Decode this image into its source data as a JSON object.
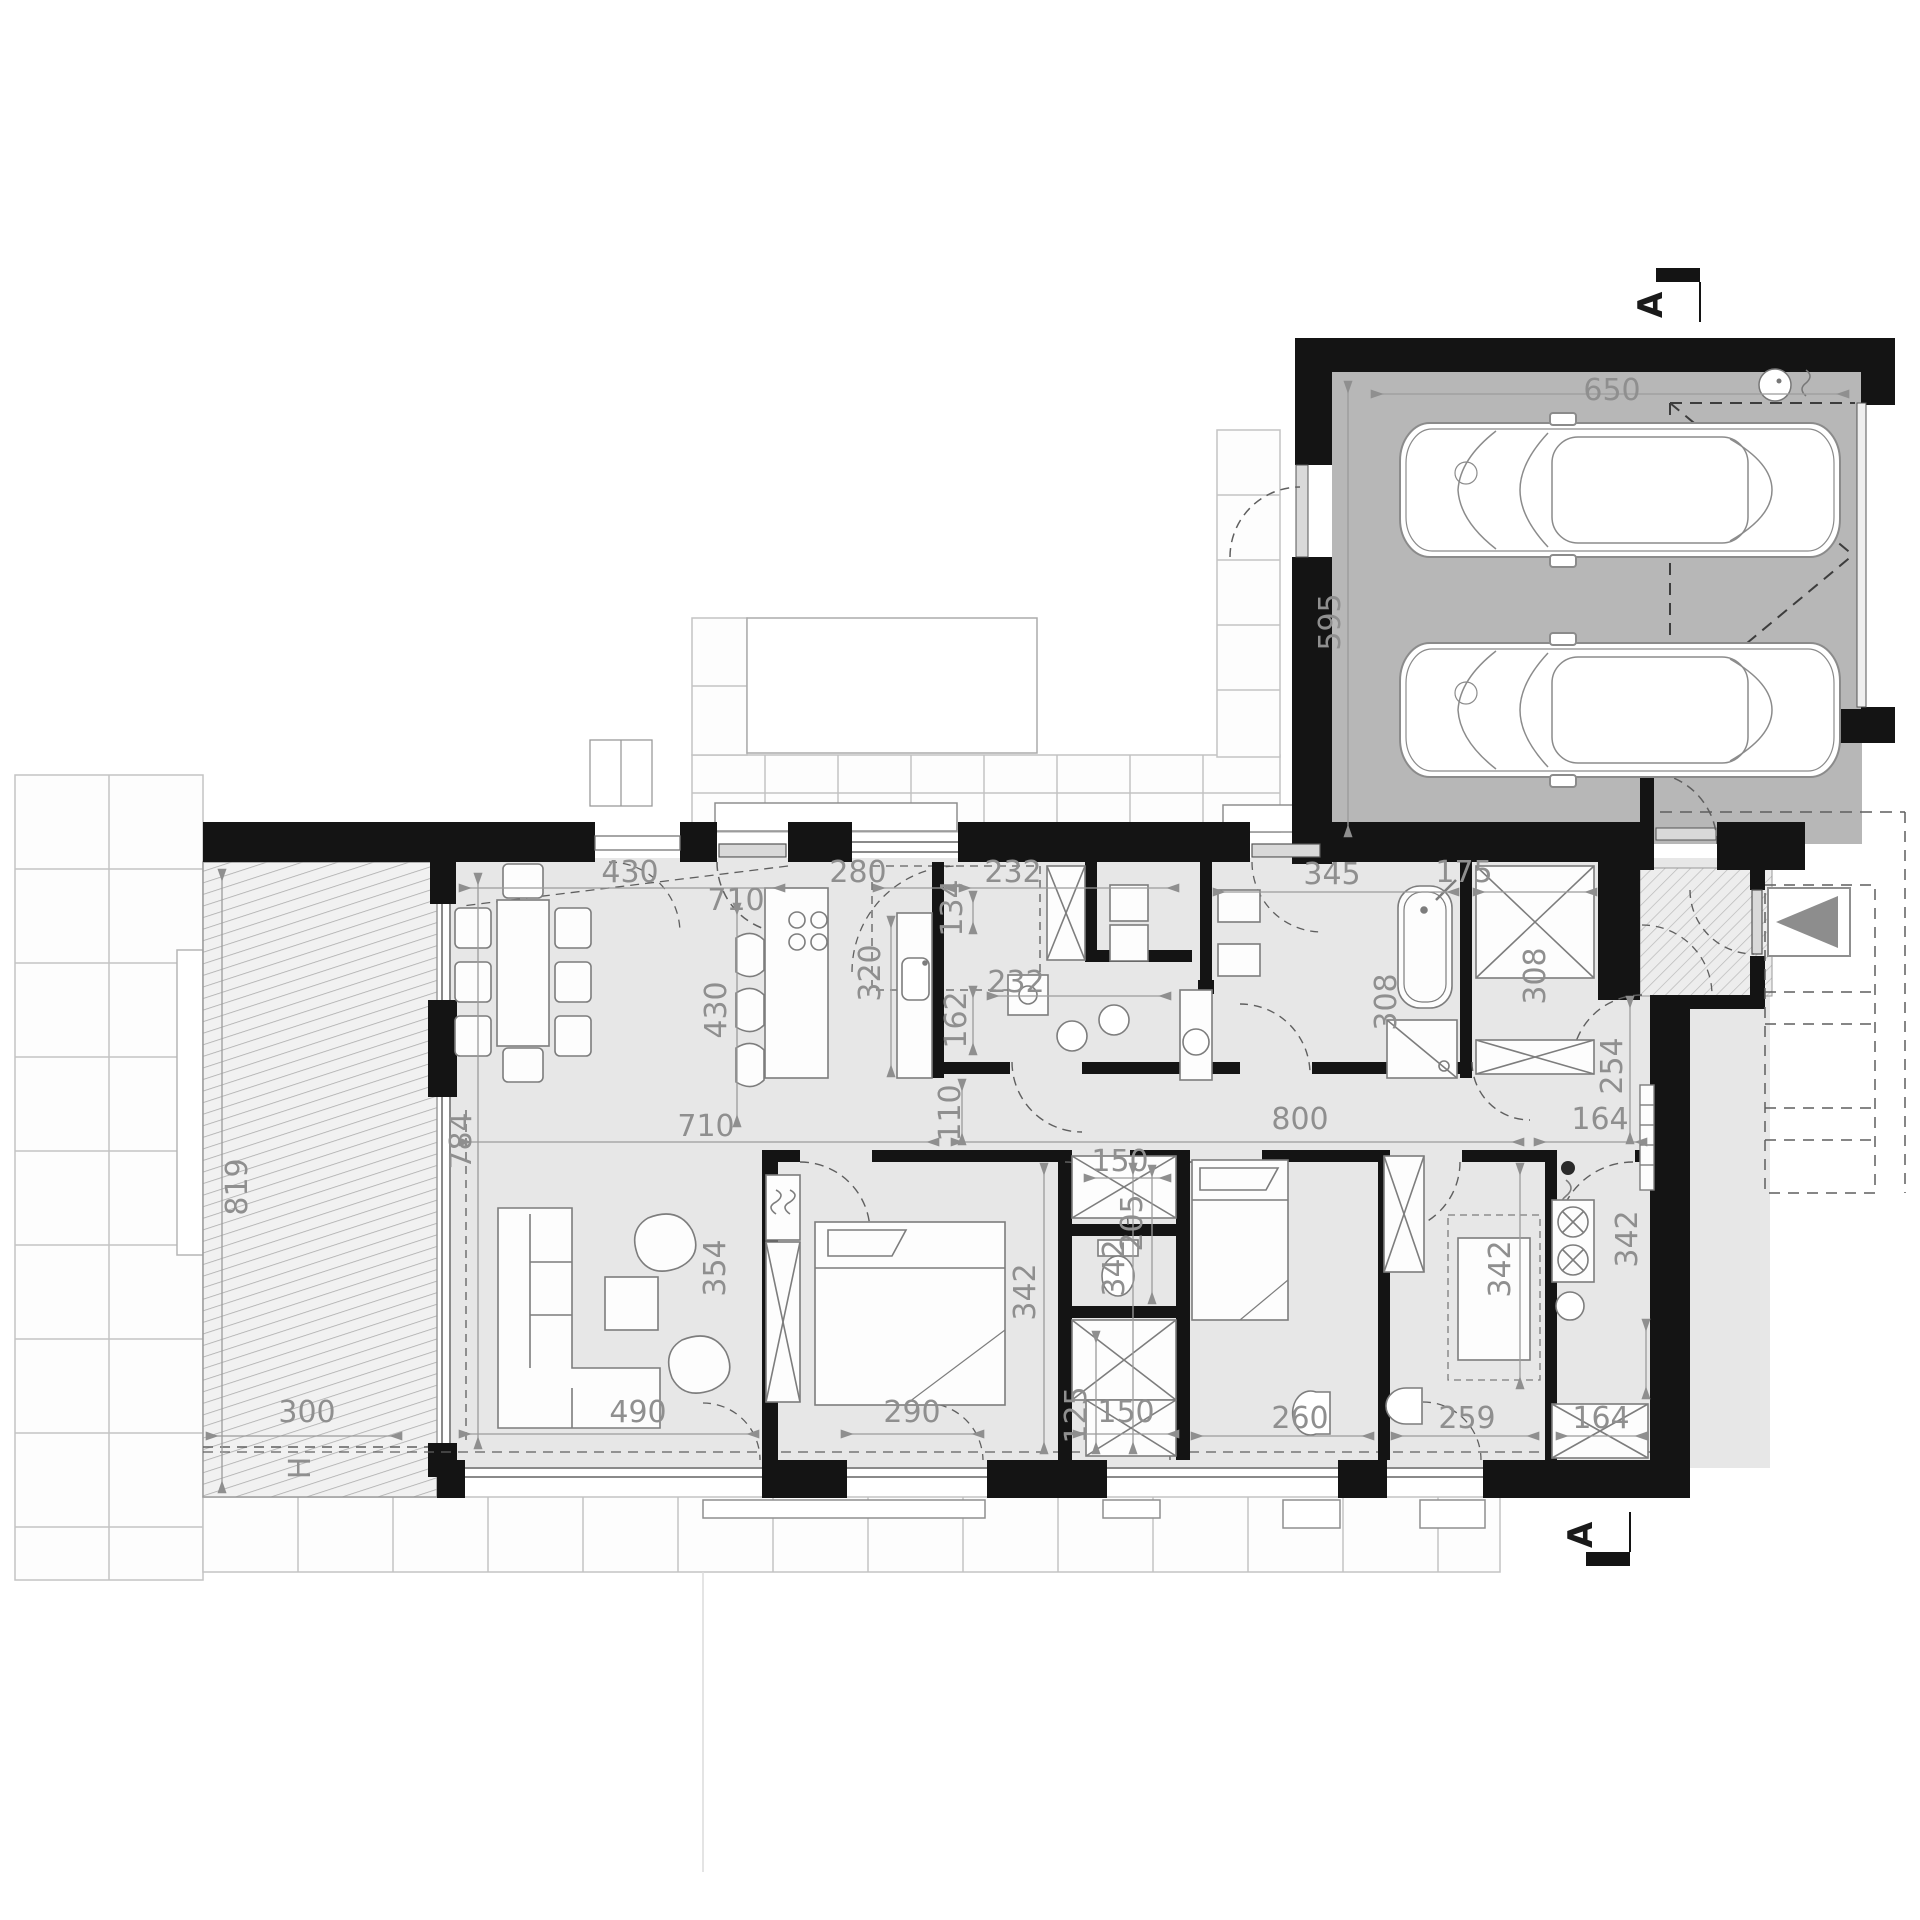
{
  "document": {
    "type": "architectural-floor-plan",
    "style": "black-wall ground floor plan with furniture, dimensions in centimeters",
    "background": "#ffffff"
  },
  "colors": {
    "wall": "#141414",
    "floor": "#e7e7e7",
    "garage_floor": "#b7b7b7",
    "dimension_text": "#8f8f8f",
    "dimension_line": "#9b9b9b",
    "furniture_stroke": "#7d7d7d",
    "tile_line": "#c3c3c3",
    "hatch_line": "#a9a9a9",
    "dashed_line": "#5f5f5f",
    "arrow_fill": "#8d8d8d"
  },
  "section_markers": [
    {
      "label": "A",
      "position": "top-right"
    },
    {
      "label": "A",
      "position": "bottom-right"
    }
  ],
  "rooms_depicted": [
    "garage-two-cars",
    "entry-vestibule",
    "hall",
    "corridor",
    "living-dining-room",
    "kitchen-with-island",
    "laundry-pantry",
    "bathroom-with-tub-and-shower",
    "wardrobe-closet",
    "bedroom-1",
    "wc-closet-block",
    "bedroom-2",
    "bathroom-2",
    "utility-boiler-room",
    "terrace",
    "garden-paths"
  ],
  "labels": [
    {
      "text": "430",
      "x": 630,
      "y": 882,
      "rot": 0
    },
    {
      "text": "710",
      "x": 736,
      "y": 910,
      "rot": 0
    },
    {
      "text": "280",
      "x": 858,
      "y": 882,
      "rot": 0
    },
    {
      "text": "232",
      "x": 1013,
      "y": 882,
      "rot": 0
    },
    {
      "text": "345",
      "x": 1332,
      "y": 884,
      "rot": 0
    },
    {
      "text": "175",
      "x": 1464,
      "y": 882,
      "rot": 0
    },
    {
      "text": "650",
      "x": 1612,
      "y": 400,
      "rot": 0
    },
    {
      "text": "595",
      "x": 1340,
      "y": 622,
      "rot": -90
    },
    {
      "text": "134",
      "x": 962,
      "y": 908,
      "rot": -90
    },
    {
      "text": "320",
      "x": 880,
      "y": 973,
      "rot": -90
    },
    {
      "text": "430",
      "x": 726,
      "y": 1010,
      "rot": -90
    },
    {
      "text": "162",
      "x": 966,
      "y": 1020,
      "rot": -90
    },
    {
      "text": "232",
      "x": 1016,
      "y": 992,
      "rot": 0
    },
    {
      "text": "308",
      "x": 1396,
      "y": 1002,
      "rot": -90
    },
    {
      "text": "308",
      "x": 1545,
      "y": 976,
      "rot": -90
    },
    {
      "text": "110",
      "x": 960,
      "y": 1113,
      "rot": -90
    },
    {
      "text": "800",
      "x": 1300,
      "y": 1129,
      "rot": 0
    },
    {
      "text": "164",
      "x": 1600,
      "y": 1129,
      "rot": 0
    },
    {
      "text": "254",
      "x": 1622,
      "y": 1066,
      "rot": -90
    },
    {
      "text": "710",
      "x": 706,
      "y": 1136,
      "rot": 0
    },
    {
      "text": "784",
      "x": 471,
      "y": 1141,
      "rot": -90
    },
    {
      "text": "819",
      "x": 247,
      "y": 1187,
      "rot": -90
    },
    {
      "text": "354",
      "x": 725,
      "y": 1268,
      "rot": -90
    },
    {
      "text": "342",
      "x": 1035,
      "y": 1292,
      "rot": -90
    },
    {
      "text": "342",
      "x": 1124,
      "y": 1268,
      "rot": -90
    },
    {
      "text": "205",
      "x": 1142,
      "y": 1223,
      "rot": -90
    },
    {
      "text": "150",
      "x": 1120,
      "y": 1171,
      "rot": 0
    },
    {
      "text": "125",
      "x": 1086,
      "y": 1415,
      "rot": -90
    },
    {
      "text": "150",
      "x": 1126,
      "y": 1422,
      "rot": 0
    },
    {
      "text": "290",
      "x": 912,
      "y": 1422,
      "rot": 0
    },
    {
      "text": "490",
      "x": 638,
      "y": 1422,
      "rot": 0
    },
    {
      "text": "300",
      "x": 307,
      "y": 1422,
      "rot": 0
    },
    {
      "text": "260",
      "x": 1300,
      "y": 1428,
      "rot": 0
    },
    {
      "text": "259",
      "x": 1467,
      "y": 1428,
      "rot": 0
    },
    {
      "text": "164",
      "x": 1601,
      "y": 1428,
      "rot": 0
    },
    {
      "text": "342",
      "x": 1510,
      "y": 1269,
      "rot": -90
    },
    {
      "text": "342",
      "x": 1637,
      "y": 1239,
      "rot": -90
    },
    {
      "text": "H",
      "x": 310,
      "y": 1468,
      "rot": -90
    }
  ]
}
